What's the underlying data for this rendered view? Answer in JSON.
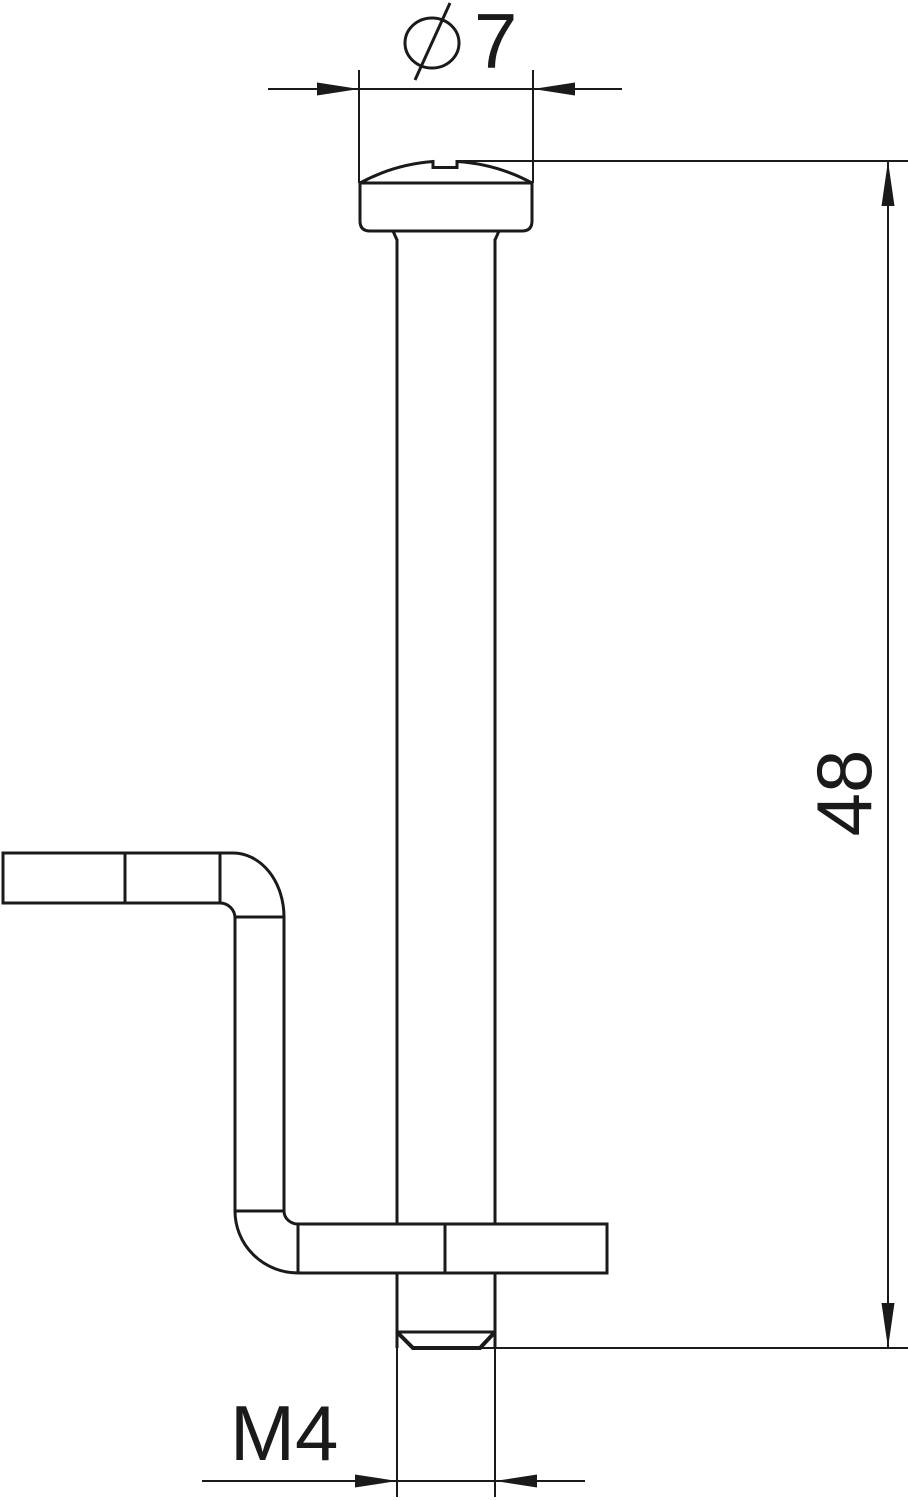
{
  "drawing_title": "screw-with-z-bracket-technical-drawing",
  "colors": {
    "background": "#ffffff",
    "line": "#1a1a1a",
    "text": "#1a1a1a"
  },
  "dimensions": {
    "head_diameter": {
      "symbol": "Ø",
      "value": "7"
    },
    "overall_length": {
      "value": "48"
    },
    "thread_size": {
      "value": "M4"
    }
  }
}
